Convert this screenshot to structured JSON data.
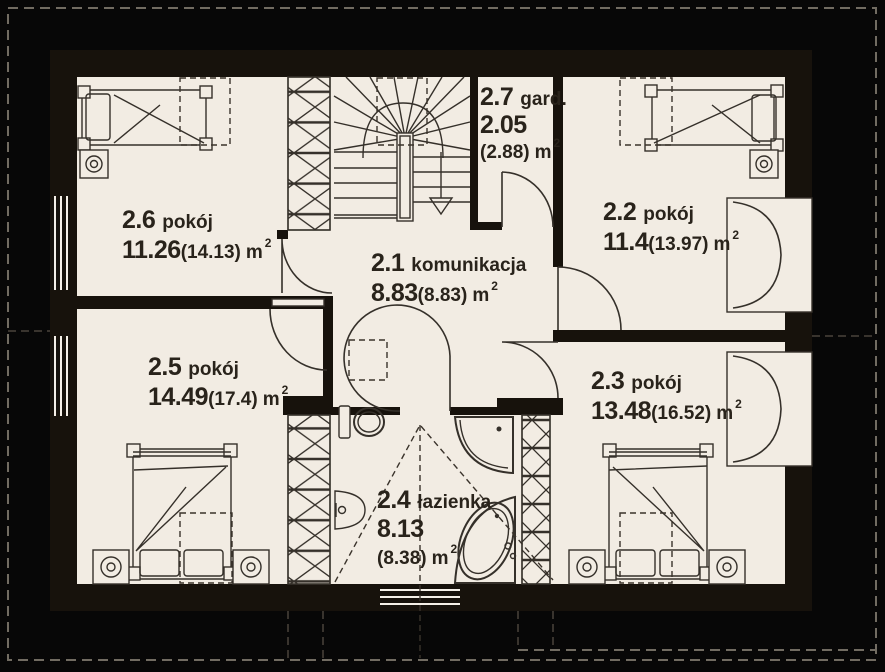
{
  "colors": {
    "background": "#070707",
    "floor": "#f2ece3",
    "wall": "#17120c",
    "line": "#35302a",
    "roof_dash": "#716c62",
    "text": "#29231b"
  },
  "rooms": {
    "r21": {
      "num": "2.1",
      "name": "komunikacja",
      "area": "8.83",
      "paren": "(8.83)",
      "unit": "m",
      "sup": "2"
    },
    "r22": {
      "num": "2.2",
      "name": "pokój",
      "area": "11.4",
      "paren": "(13.97)",
      "unit": "m",
      "sup": "2"
    },
    "r23": {
      "num": "2.3",
      "name": "pokój",
      "area": "13.48",
      "paren": "(16.52)",
      "unit": "m",
      "sup": "2"
    },
    "r24": {
      "num": "2.4",
      "name": "łazienka",
      "area": "8.13",
      "paren": "(8.38)",
      "unit": "m",
      "sup": "2"
    },
    "r25": {
      "num": "2.5",
      "name": "pokój",
      "area": "14.49",
      "paren": "(17.4)",
      "unit": "m",
      "sup": "2"
    },
    "r26": {
      "num": "2.6",
      "name": "pokój",
      "area": "11.26",
      "paren": "(14.13)",
      "unit": "m",
      "sup": "2"
    },
    "r27": {
      "num": "2.7",
      "name": "gard.",
      "area": "2.05",
      "paren": "(2.88)",
      "unit": "m",
      "sup": "2"
    }
  }
}
